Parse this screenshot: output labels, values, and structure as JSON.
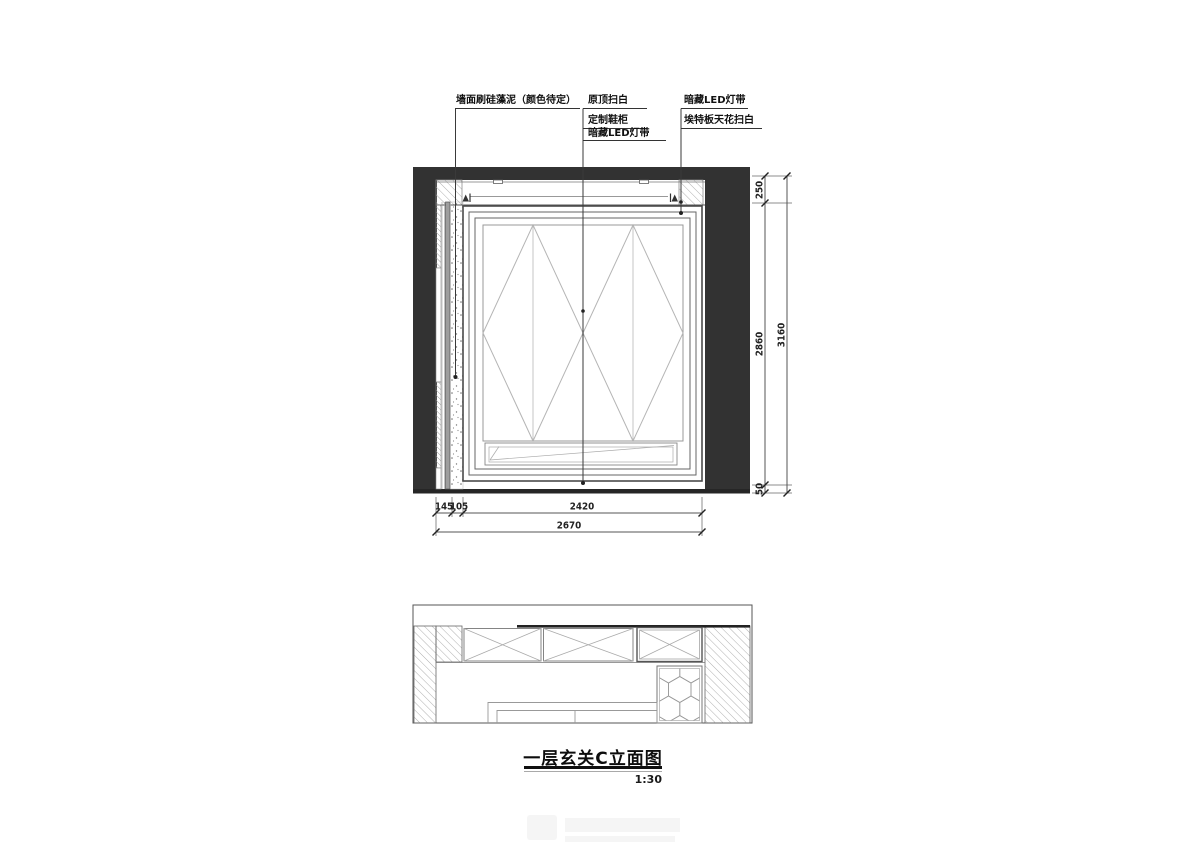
{
  "title": {
    "text": "一层玄关C立面图",
    "scale": "1:30"
  },
  "annotations": {
    "wall_finish": "墙面刷硅藻泥（颜色待定）",
    "ceiling_paint": "原顶扫白",
    "shoe_cabinet": "定制鞋柜",
    "led_strip": "暗藏LED灯带",
    "led_strip_right": "暗藏LED灯带",
    "etex_ceiling": "埃特板天花扫白"
  },
  "dimensions": {
    "right": {
      "seg1": "250",
      "seg2": "2860",
      "seg3": "50",
      "total": "3160"
    },
    "bottom": {
      "seg1": "145",
      "seg2": "105",
      "seg3": "2420",
      "total": "2670"
    }
  },
  "colors": {
    "wall_fill": "#323232",
    "floor_fill": "#262626",
    "line_dark": "#3a3a3a",
    "line_mid": "#777777",
    "line_light": "#b5b5b5"
  }
}
